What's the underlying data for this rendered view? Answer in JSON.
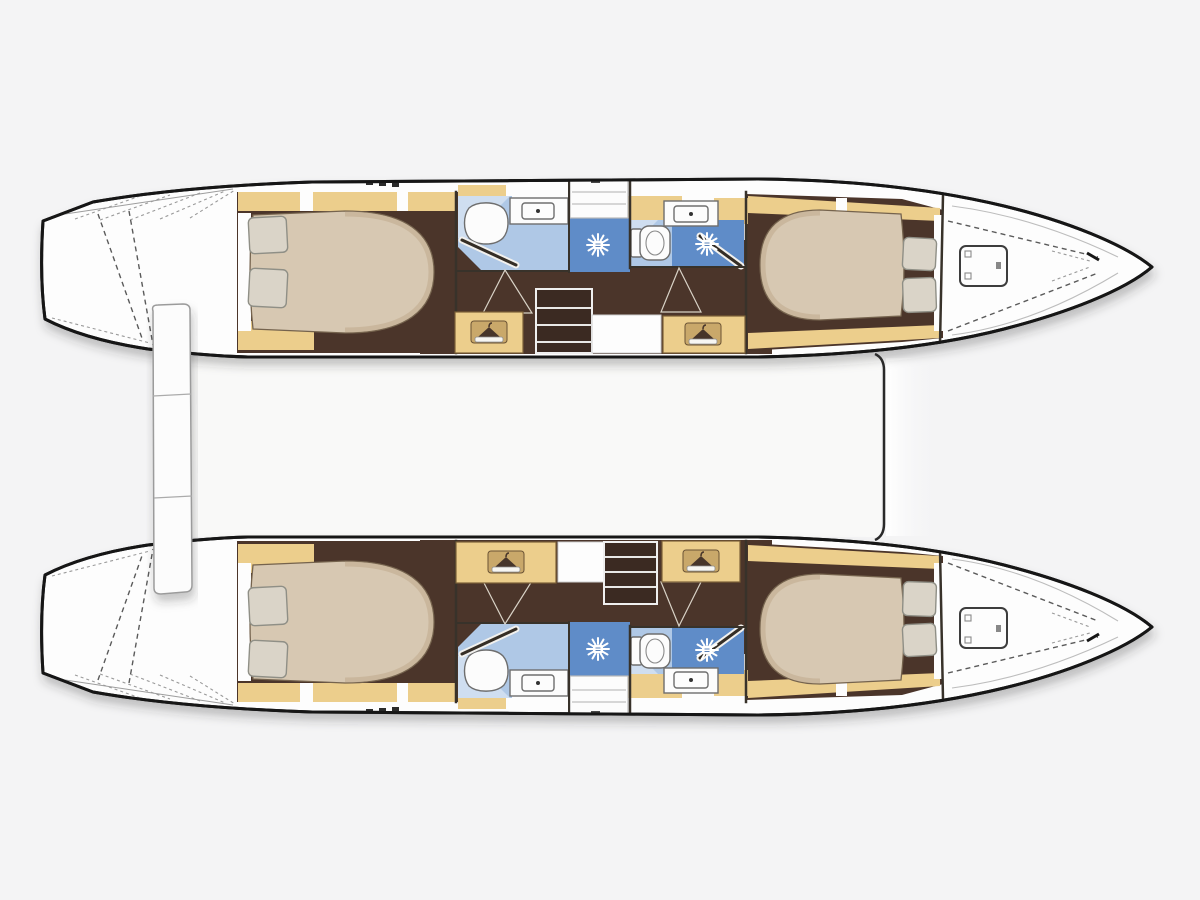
{
  "vessel": {
    "kind": "catamaran interior floor plan (top view)",
    "orientation": "bows pointing right",
    "hull_count": 2
  },
  "per_hull_spaces": {
    "aft_cabin": {
      "double_berth": 1,
      "pillows": 2,
      "hanging_locker": 1,
      "side_shelves": "wood trim"
    },
    "aft_head": {
      "toilet": 1,
      "washbasin": 1,
      "shower_cubicle": 1,
      "shower_head_icon": 1
    },
    "companionway_steps": 1,
    "drawer_unit": 1,
    "forward_head": {
      "toilet": 1,
      "washbasin": 1,
      "shower_cubicle": 1,
      "shower_head_icon": 1
    },
    "forward_cabin": {
      "double_berth": 1,
      "pillows": 2
    },
    "foredeck": {
      "deck_hatch": 1,
      "dashed_deck_lines": true
    },
    "stern": {
      "swim_platform_steps": true,
      "hatched_deck_band": true
    }
  },
  "deck_features": {
    "stern_side_plank": 1,
    "bridgedeck_forward_edge": 1
  },
  "palette": {
    "background": "#f4f4f5",
    "hull_fill": "#fdfdfd",
    "outline": "#181818",
    "wood": "#ecce8c",
    "wood_border": "#7c6137",
    "floor": "#4b3429",
    "chest": "#3a2a21",
    "bed": "#d7c8b2",
    "bed_shade": "#bfaa8c",
    "bed_line": "#74634e",
    "pillow": "#dad4c8",
    "pillow_line": "#8f8f86",
    "bath": "#afc8e6",
    "bath_light": "#cfdef0",
    "shower": "#5f8cc8",
    "fixture": "#fcfcfc",
    "fixture_line": "#6e6e6e",
    "wall": "#38302a",
    "deck_line": "#9b9b9b",
    "dash": "#5a5a5a",
    "dash_light": "#9a9a9a",
    "cleat": "#2b2b2b",
    "badge": "#c9a86a",
    "badge_border": "#6b5335",
    "hanger": "#463429",
    "rail": "#f7f6f2",
    "star": "#ffffff"
  }
}
